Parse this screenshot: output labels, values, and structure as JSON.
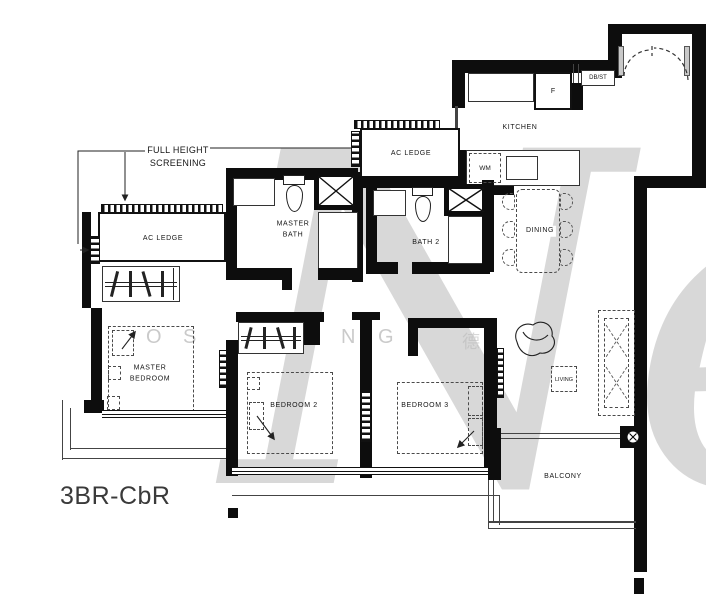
{
  "title": "3BR-CbR",
  "annotation": {
    "screening": "FULL HEIGHT\nSCREENING"
  },
  "rooms": {
    "kitchen": {
      "label": "KITCHEN"
    },
    "dining": {
      "label": "DINING"
    },
    "living": {
      "label": "LIVING"
    },
    "balcony": {
      "label": "BALCONY"
    },
    "master_bath": {
      "label": "MASTER\nBATH"
    },
    "bath2": {
      "label": "BATH 2"
    },
    "master_bedroom": {
      "label": "MASTER\nBEDROOM"
    },
    "bedroom2": {
      "label": "BEDROOM 2"
    },
    "bedroom3": {
      "label": "BEDROOM 3"
    },
    "ac_ledge_left": {
      "label": "AC LEDGE"
    },
    "ac_ledge_mid": {
      "label": "AC LEDGE"
    }
  },
  "fixtures": {
    "fridge": "F",
    "washing_machine": "WM",
    "db_st": "DB/ST"
  },
  "watermark": {
    "big": "Ne",
    "letters": [
      "O",
      "S",
      "N",
      "G",
      "德"
    ]
  },
  "colors": {
    "wall": "#0d0d0d",
    "watermark": "#b9b9b9"
  }
}
